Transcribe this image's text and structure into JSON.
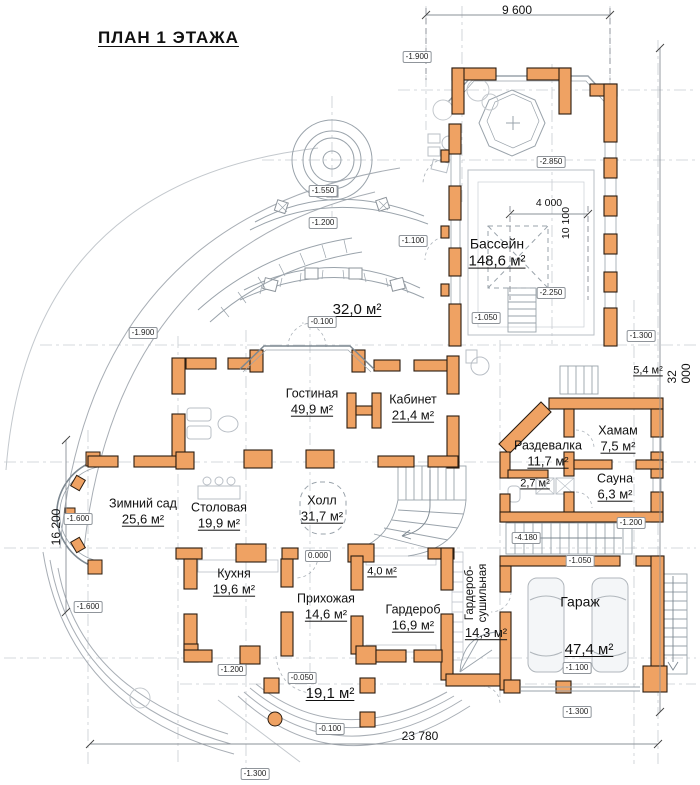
{
  "title": "ПЛАН 1 ЭТАЖА",
  "colors": {
    "wall": "#EFA263",
    "wall_stroke": "#2a1c10",
    "line_gray": "#9aa3ab",
    "axis_gray": "#c8cdd2",
    "text": "#111111"
  },
  "rooms": {
    "pool": {
      "name": "Бассейн",
      "area": "148,6 м²"
    },
    "terrace_upper": {
      "area": "32,0 м²"
    },
    "living": {
      "name": "Гостиная",
      "area": "49,9 м²"
    },
    "cabinet": {
      "name": "Кабинет",
      "area": "21,4 м²"
    },
    "winter_garden": {
      "name": "Зимний сад",
      "area": "25,6 м²"
    },
    "dining": {
      "name": "Столовая",
      "area": "19,9 м²"
    },
    "hall": {
      "name": "Холл",
      "area": "31,7 м²"
    },
    "kitchen": {
      "name": "Кухня",
      "area": "19,6 м²"
    },
    "entry": {
      "name": "Прихожая",
      "area": "14,6 м²"
    },
    "wardrobe": {
      "name": "Гардероб",
      "area": "16,9 м²"
    },
    "drying": {
      "name_line1": "Гардероб-",
      "name_line2": "сушильная",
      "area": "14,3 м²"
    },
    "changing": {
      "name": "Раздевалка",
      "area": "11,7 м²"
    },
    "wc": {
      "area": "2,7 м²"
    },
    "hamam": {
      "name": "Хамам",
      "area": "7,5 м²"
    },
    "sauna": {
      "name": "Сауна",
      "area": "6,3 м²"
    },
    "room54": {
      "area": "5,4 м²"
    },
    "garage": {
      "name": "Гараж",
      "area": "47,4 м²"
    },
    "terrace_lower": {
      "area": "19,1 м²"
    },
    "storage40": {
      "area": "4,0 м²"
    }
  },
  "dimensions": {
    "top": "9 600",
    "right": "32 000",
    "left": "16 200",
    "bottom": "23 780",
    "pool_width": "4 000",
    "pool_length": "10 100"
  },
  "levels": [
    "-1.900",
    "-2.850",
    "-1.550",
    "-1.200",
    "-1.100",
    "-2.250",
    "-1.050",
    "-0.100",
    "-1.900",
    "-1.300",
    "-1.600",
    "-1.200",
    "-4.180",
    "0.000",
    "-1.050",
    "-1.600",
    "-1.200",
    "-0.050",
    "-1.100",
    "-1.300",
    "-0.100",
    "-1.300"
  ]
}
